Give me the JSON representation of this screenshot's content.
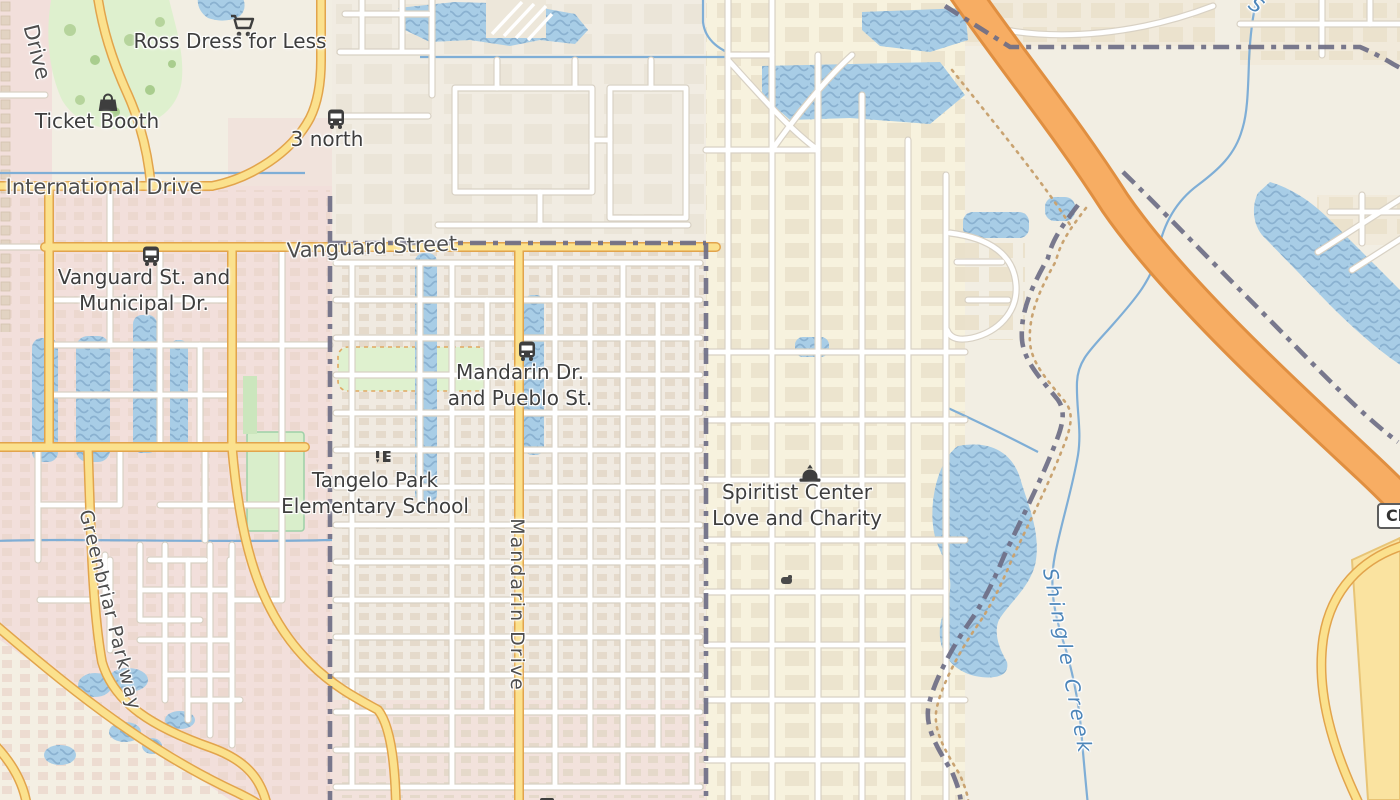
{
  "colors": {
    "water": "#A8CDE6",
    "wave": "#8AB1D0",
    "road-yellow": "#FBE18D",
    "road-yellow-casing": "#E2A44C",
    "highway": "#F7AD63",
    "highway-casing": "#E08F41",
    "road-white": "#FFFFFF",
    "road-casing": "#D8D1C4",
    "boundary": "#6E6E86",
    "dotted": "#C9A371",
    "creek": "#7FAED6",
    "park": "#DEF0CE",
    "label": "#3E3E3E",
    "water-label": "#4D86BA"
  },
  "labels": {
    "pois": [
      {
        "id": "ross-dress-for-less",
        "icon": "shopping-cart-icon",
        "lines": [
          "Ross Dress for Less"
        ]
      },
      {
        "id": "ticket-booth",
        "icon": "handbag-icon",
        "lines": [
          "Ticket Booth"
        ]
      },
      {
        "id": "bus-stop-3-north",
        "icon": "bus-icon",
        "lines": [
          "3 north"
        ]
      },
      {
        "id": "bus-stop-vanguard-municipal",
        "icon": "bus-icon",
        "lines": [
          "Vanguard St. and",
          "Municipal Dr."
        ]
      },
      {
        "id": "bus-stop-mandarin-pueblo",
        "icon": "bus-icon",
        "lines": [
          "Mandarin Dr.",
          "and Pueblo St."
        ]
      },
      {
        "id": "tangelo-park-elementary-school",
        "icon": "school-icon",
        "lines": [
          "Tangelo Park",
          "Elementary School"
        ]
      },
      {
        "id": "spiritist-center",
        "icon": "place-of-worship-icon",
        "lines": [
          "Spiritist Center",
          "Love and Charity"
        ]
      }
    ],
    "streets": [
      {
        "id": "international-drive",
        "text": "International Drive"
      },
      {
        "id": "vanguard-street",
        "text": "Vanguard Street"
      },
      {
        "id": "mandarin-drive",
        "text": "Mandarin Drive"
      },
      {
        "id": "greenbriar-parkway",
        "text": "Greenbriar Parkway"
      },
      {
        "id": "drive-partial",
        "text": "Drive"
      }
    ],
    "water": [
      {
        "id": "shingle-creek",
        "text": "Shingle Creek"
      },
      {
        "id": "creek-label-partial",
        "text": "S"
      }
    ],
    "shield": {
      "text": "Cl"
    }
  }
}
